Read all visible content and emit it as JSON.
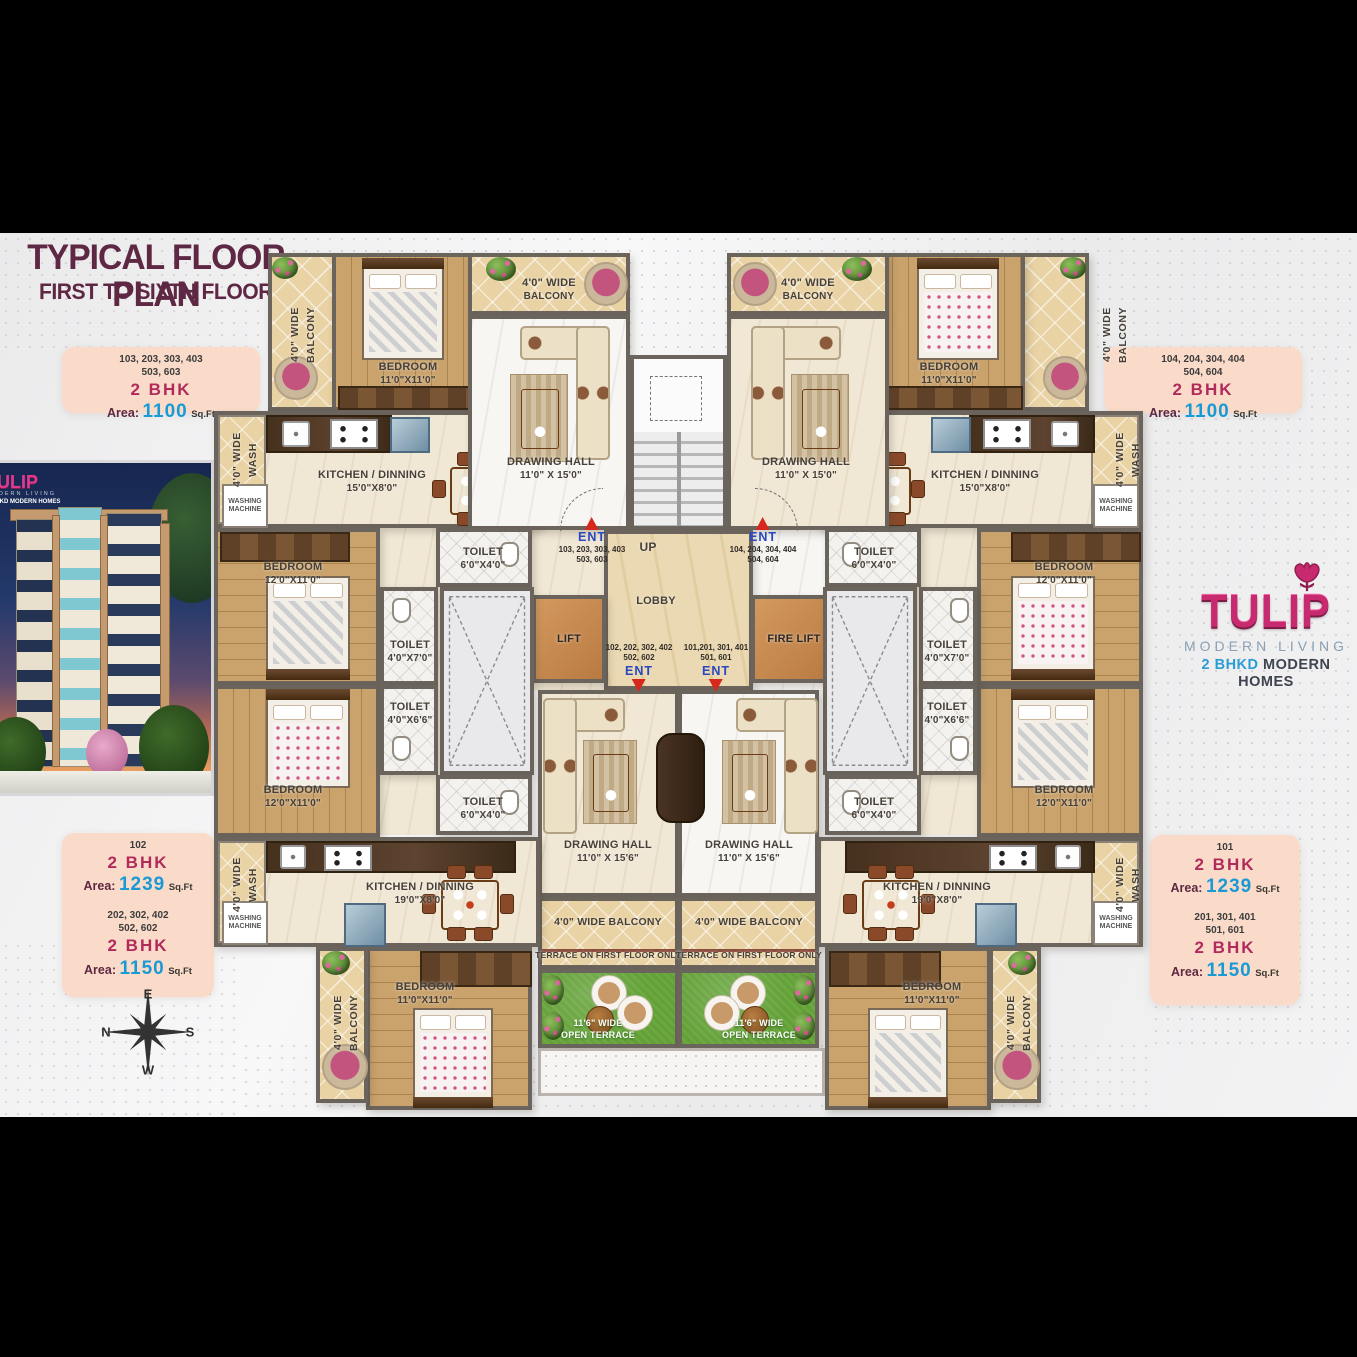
{
  "header": {
    "title": "TYPICAL FLOOR PLAN",
    "subtitle": "FIRST TO SIXTH FLOOR"
  },
  "colors": {
    "accent_pink": "#b02a5c",
    "accent_blue": "#1a9ad4",
    "maroon": "#5e2743",
    "card_bg": "#fadbc9"
  },
  "cards": {
    "area_label": "Area:",
    "sqft": "Sq.Ft",
    "bhk": "2 BHK",
    "tl": {
      "u1": "103, 203, 303, 403",
      "u2": "503, 603",
      "area": "1100"
    },
    "tr": {
      "u1": "104, 204, 304, 404",
      "u2": "504, 604",
      "area": "1100"
    },
    "bl1": {
      "u1": "102",
      "area": "1239"
    },
    "bl2": {
      "u1": "202, 302, 402",
      "u2": "502, 602",
      "area": "1150"
    },
    "br1": {
      "u1": "101",
      "area": "1239"
    },
    "br2": {
      "u1": "201, 301, 401",
      "u2": "501, 601",
      "area": "1150"
    }
  },
  "logo": {
    "name": "TULIP",
    "tagline": "MODERN LIVING",
    "bhkd": "2 BHKD",
    "homes": "MODERN HOMES"
  },
  "compass": {
    "n": "N",
    "e": "E",
    "s": "S",
    "w": "W"
  },
  "plan": {
    "bedroom": "BEDROOM",
    "d11": "11'0\"X11'0\"",
    "d12": "12'0\"X11'0\"",
    "kitchen": "KITCHEN / DINNING",
    "k15": "15'0\"X8'0\"",
    "k19": "19'0\"X8'0\"",
    "dhall": "DRAWING HALL",
    "dh15": "11'0\" X 15'0\"",
    "dh156": "11'0\" X 15'6\"",
    "toilet": "TOILET",
    "t64": "6'0\"X4'0\"",
    "t47": "4'0\"X7'0\"",
    "t466": "4'0\"X6'6\"",
    "balc1": "4'0\" WIDE",
    "balc2": "BALCONY",
    "wash1": "4'0\" WIDE",
    "wash2": "WASH",
    "wm1": "WASHING",
    "wm2": "MACHINE",
    "lobby": "LOBBY",
    "lift": "LIFT",
    "firelift": "FIRE LIFT",
    "up": "UP",
    "ent": "ENT",
    "u_tl1": "103, 203, 303, 403",
    "u_tl2": "503, 603",
    "u_tr1": "104, 204, 304, 404",
    "u_tr2": "504, 604",
    "u_bl1": "102, 202, 302, 402",
    "u_bl2": "502, 602",
    "u_br1": "101,201, 301, 401",
    "u_br2": "501, 601",
    "tnote": "TERRACE ON FIRST FLOOR ONLY",
    "ot1": "11'6\" WIDE",
    "ot2": "OPEN TERRACE"
  }
}
